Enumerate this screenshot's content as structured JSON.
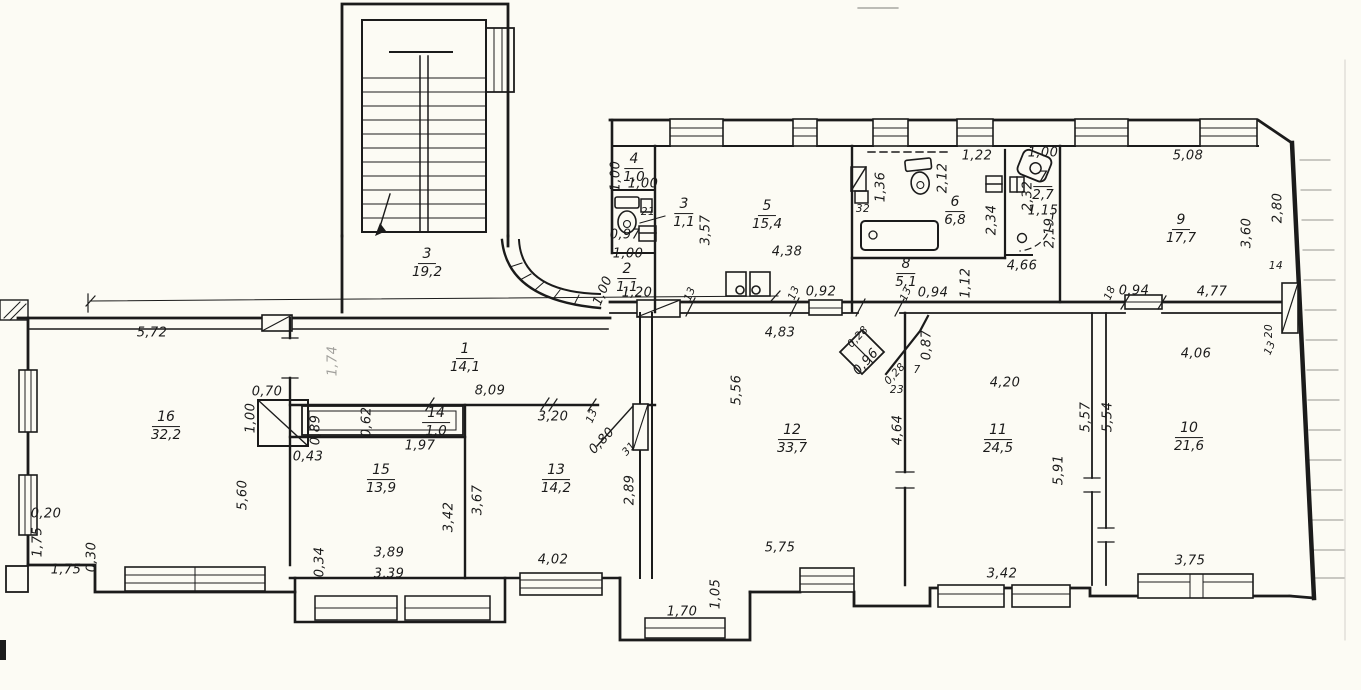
{
  "meta": {
    "drawing_type": "scanned architectural floor plan",
    "paper_color": "#fcfbf4",
    "ink_color": "#1b1b1b"
  },
  "rooms": {
    "stairwell": {
      "number": "3",
      "area": "19,2"
    },
    "r1": {
      "number": "1",
      "area": "14,1"
    },
    "r2": {
      "number": "2",
      "area": "1,1"
    },
    "r3": {
      "number": "3",
      "area": "1,1"
    },
    "r4": {
      "number": "4",
      "area": "1,0"
    },
    "r5": {
      "number": "5",
      "area": "15,4"
    },
    "r6": {
      "number": "6",
      "area": "6,8"
    },
    "r7": {
      "number": "7",
      "area": "2,7"
    },
    "r8": {
      "number": "8",
      "area": "5,1"
    },
    "r9": {
      "number": "9",
      "area": "17,7"
    },
    "r10": {
      "number": "10",
      "area": "21,6"
    },
    "r11": {
      "number": "11",
      "area": "24,5"
    },
    "r12": {
      "number": "12",
      "area": "33,7"
    },
    "r13": {
      "number": "13",
      "area": "14,2"
    },
    "r14": {
      "number": "14",
      "area": "1,0"
    },
    "r15": {
      "number": "15",
      "area": "13,9"
    },
    "r16": {
      "number": "16",
      "area": "32,2"
    }
  },
  "dims": [
    "5,72",
    "0,70",
    "1,00",
    "0,89",
    "0,43",
    "5,60",
    "0,20",
    "1,75",
    "1,75",
    "0,30",
    "0,34",
    "1,74",
    "8,09",
    "0,62",
    "1,97",
    "3,20",
    "13",
    "0,80",
    "31",
    "3,89",
    "3,39",
    "3,42",
    "3,67",
    "4,02",
    "2,89",
    "4,83",
    "5,56",
    "5,75",
    "4,64",
    "1,70",
    "1,05",
    "0,28",
    "0,96",
    "0,28",
    "23",
    "0,87",
    "7",
    "4,20",
    "5,91",
    "5,57",
    "5,54",
    "3,42",
    "4,06",
    "3,75",
    "20",
    "13",
    "5,08",
    "2,80",
    "3,60",
    "14",
    "4,77",
    "0.94",
    "18",
    "1,22",
    "1,00",
    "2,12",
    "1,36",
    "32",
    "2,34",
    "2,32",
    "1,15",
    "2,19",
    "4,66",
    "1,12",
    "0,94",
    "13",
    "4,38",
    "3,57",
    "0,92",
    "13",
    "13",
    "21",
    "0,97",
    "1,00",
    "1,20",
    "1,00",
    "1,00",
    "1,00"
  ],
  "symbols": [
    "stairs-icon",
    "toilet-icon",
    "bathtub-icon",
    "sink-icon",
    "stove-icon",
    "radiator-icon",
    "window-icon",
    "door-swing-icon",
    "flue-icon"
  ]
}
